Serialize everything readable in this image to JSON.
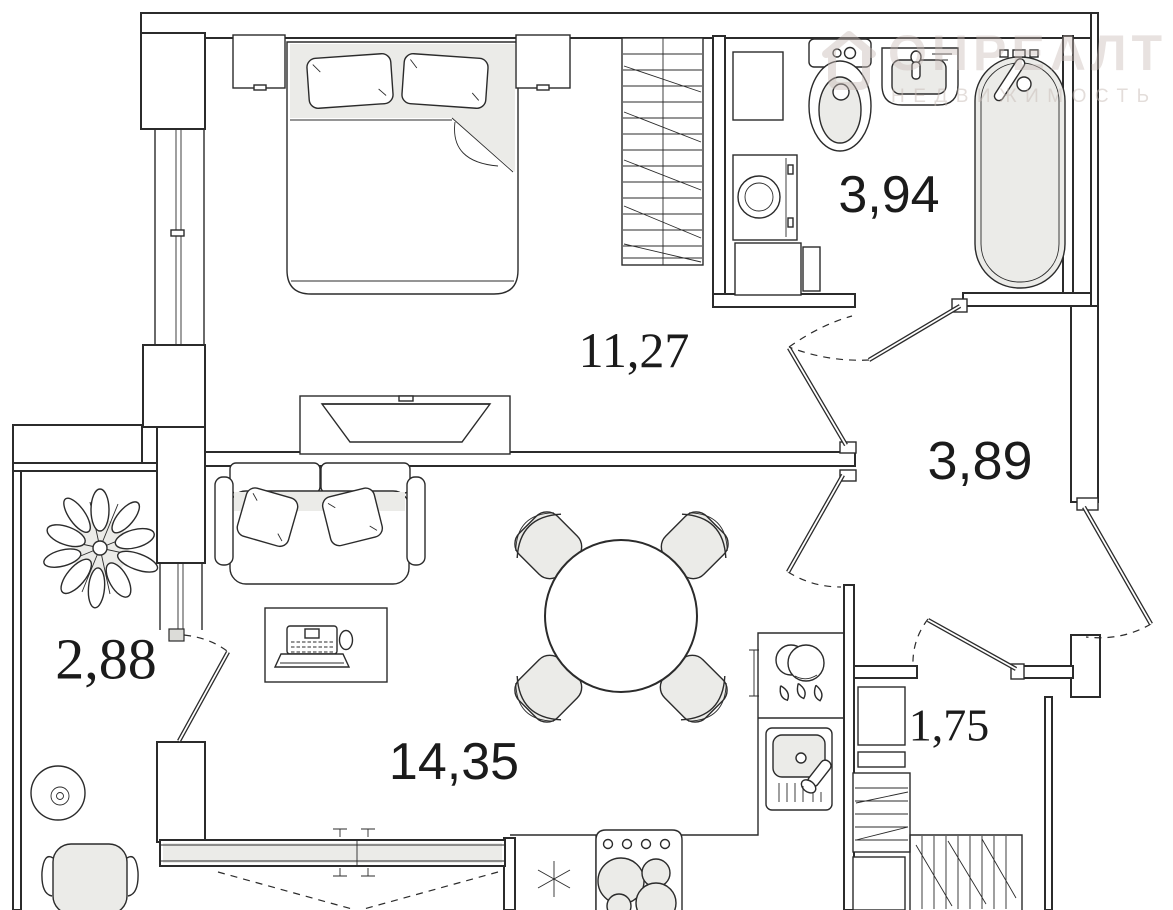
{
  "plan": {
    "rooms": {
      "bedroom": {
        "area": "11,27"
      },
      "bathroom": {
        "area": "3,94"
      },
      "hallway": {
        "area": "3,89"
      },
      "balcony": {
        "area": "2,88"
      },
      "living_kitchen": {
        "area": "14,35"
      },
      "storage": {
        "area": "1,75"
      }
    }
  },
  "watermark": {
    "brand": "ОНРЕАЛТ",
    "tagline": "НЕДВИЖИМОСТЬ"
  },
  "colors": {
    "line": "#2b2b2b",
    "fixture_fill": "#ebebe8",
    "watermark": "#c7bbb6"
  }
}
